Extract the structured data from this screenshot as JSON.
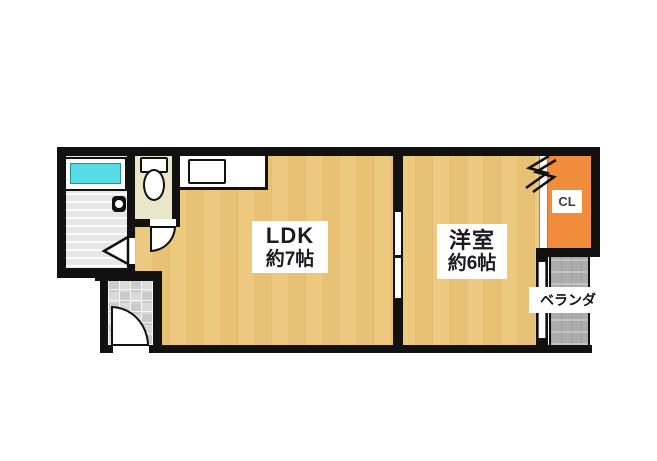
{
  "plan_title": "1LDK apartment floor plan",
  "rooms": {
    "ldk": {
      "name": "LDK",
      "size": "約7帖"
    },
    "bedroom": {
      "name": "洋室",
      "size": "約6帖"
    },
    "closet": {
      "label": "CL"
    },
    "veranda": {
      "label": "ベランダ"
    }
  },
  "fixtures": {
    "bathtub": "bathtub",
    "shower_faucet": "shower-faucet",
    "toilet": "toilet",
    "kitchen_counter": "kitchen-counter",
    "kitchen_sink": "kitchen-sink",
    "bathroom_folding_door": "folding-door",
    "toilet_swing_door": "swing-door",
    "entrance_swing_door": "swing-door",
    "room_sliding_door": "sliding-door",
    "closet_door": "closet-door",
    "veranda_window": "window",
    "closet_accordion_mark": "zigzag-mark"
  },
  "colors": {
    "wall": "#111111",
    "wood_floor": "#ecc577",
    "closet_orange": "#f08c3c",
    "bathtub_cyan": "#55dce6",
    "toilet_room_floor": "#eae6c9",
    "bathroom_floor": "#e9e9e9",
    "entrance_tile": "#d5d5d5",
    "veranda_gray": "#acacac",
    "background": "#ffffff"
  }
}
